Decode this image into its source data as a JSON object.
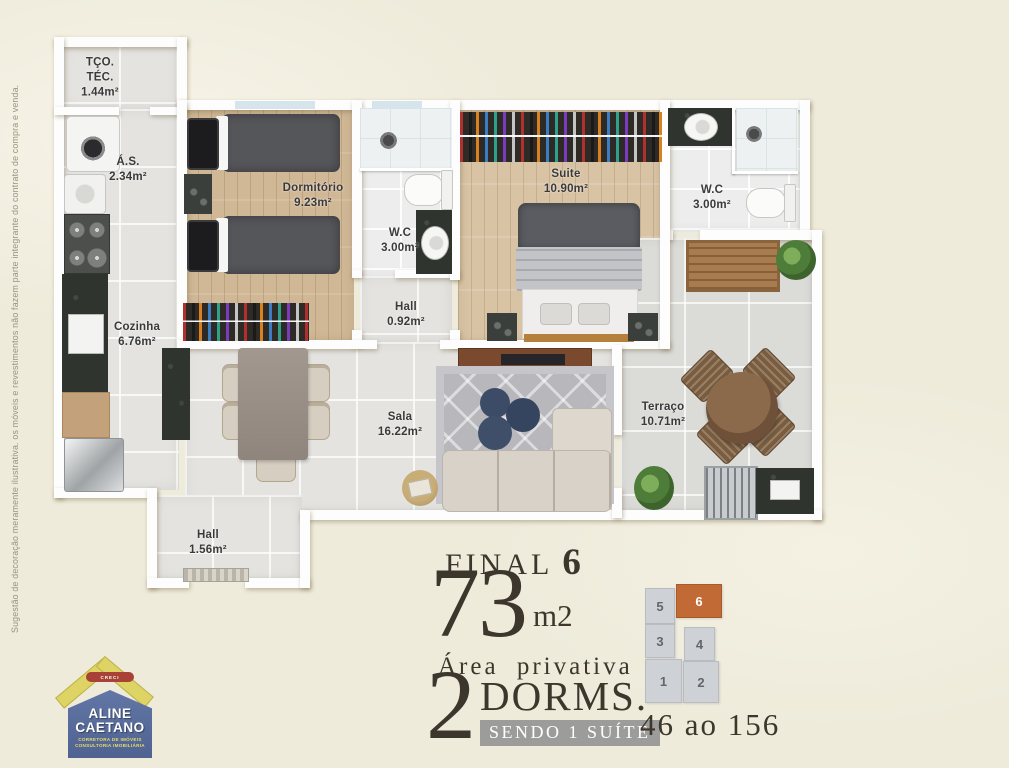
{
  "page": {
    "disclaimer": "Sugestão de decoração meramente ilustrativa. os móveis e revestimentos não fazem parte integrante do contrato de compra e venda."
  },
  "floor_plan": {
    "rooms": [
      {
        "id": "tco-tec",
        "label": "TÇO.\nTÉC.",
        "area": "1.44m²"
      },
      {
        "id": "as",
        "label": "Á.S.",
        "area": "2.34m²"
      },
      {
        "id": "dormitorio",
        "label": "Dormitório",
        "area": "9.23m²"
      },
      {
        "id": "wc-social",
        "label": "W.C",
        "area": "3.00m²"
      },
      {
        "id": "hall-intimo",
        "label": "Hall",
        "area": "0.92m²"
      },
      {
        "id": "suite",
        "label": "Suite",
        "area": "10.90m²"
      },
      {
        "id": "wc-suite",
        "label": "W.C",
        "area": "3.00m²"
      },
      {
        "id": "cozinha",
        "label": "Cozinha",
        "area": "6.76m²"
      },
      {
        "id": "sala",
        "label": "Sala",
        "area": "16.22m²"
      },
      {
        "id": "terraco",
        "label": "Terraço",
        "area": "10.71m²"
      },
      {
        "id": "hall-entrada",
        "label": "Hall",
        "area": "1.56m²"
      }
    ]
  },
  "info": {
    "final_label": "FINAL",
    "final_number": "6",
    "area_value": "73",
    "area_unit": "m2",
    "area_caption": "Área privativa",
    "dorms_number": "2",
    "dorms_label": "DORMS.",
    "suite_banner": "SENDO 1 SUÍTE",
    "units_range": "46 ao 156"
  },
  "key_plan": {
    "highlight_color": "#c26a36",
    "units": [
      {
        "number": "5",
        "highlighted": false
      },
      {
        "number": "6",
        "highlighted": true
      },
      {
        "number": "3",
        "highlighted": false
      },
      {
        "number": "4",
        "highlighted": false
      },
      {
        "number": "1",
        "highlighted": false
      },
      {
        "number": "2",
        "highlighted": false
      }
    ]
  },
  "logo": {
    "creci": "CRECI",
    "name_line1": "ALINE",
    "name_line2": "CAETANO",
    "subtitle1": "CORRETORA DE IMÓVEIS",
    "subtitle2": "CONSULTORIA IMOBILIÁRIA"
  },
  "colors": {
    "background": "#eeebdb",
    "wall": "#fdfdfd",
    "highlight_orange": "#c26a36",
    "text_dark": "#3d362c"
  }
}
